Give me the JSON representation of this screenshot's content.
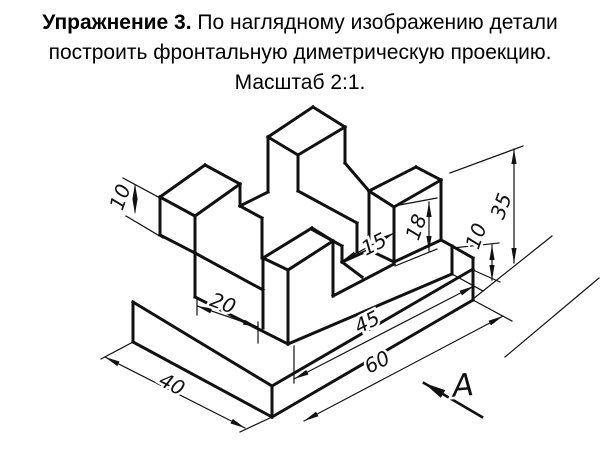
{
  "title": {
    "bold": "Упражнение 3.",
    "rest": " По наглядному изображению детали",
    "line2": "построить фронтальную диметрическую проекцию.",
    "line3": "Масштаб 2:1."
  },
  "drawing": {
    "ink": "#111111",
    "thick_width": 3,
    "thin_width": 1.2,
    "object_segments": [
      [
        133,
        302,
        133,
        342
      ],
      [
        133,
        342,
        272,
        417
      ],
      [
        272,
        417,
        272,
        386
      ],
      [
        133,
        302,
        272,
        386
      ],
      [
        272,
        417,
        473,
        300
      ],
      [
        473,
        258,
        473,
        300
      ],
      [
        272,
        386,
        473,
        269
      ],
      [
        160,
        197,
        205,
        165
      ],
      [
        205,
        165,
        240,
        184
      ],
      [
        240,
        184,
        195,
        216
      ],
      [
        195,
        216,
        160,
        197
      ],
      [
        160,
        197,
        160,
        235
      ],
      [
        195,
        216,
        195,
        297
      ],
      [
        240,
        184,
        240,
        206
      ],
      [
        160,
        235,
        195,
        253
      ],
      [
        195,
        253,
        263,
        290
      ],
      [
        240,
        206,
        268,
        192
      ],
      [
        240,
        206,
        262,
        218
      ],
      [
        262,
        218,
        262,
        258
      ],
      [
        268,
        137,
        313,
        107
      ],
      [
        313,
        107,
        345,
        127
      ],
      [
        345,
        127,
        298,
        155
      ],
      [
        298,
        155,
        268,
        137
      ],
      [
        268,
        137,
        268,
        192
      ],
      [
        298,
        155,
        298,
        191
      ],
      [
        345,
        127,
        345,
        163
      ],
      [
        298,
        191,
        357,
        223
      ],
      [
        345,
        163,
        369,
        191
      ],
      [
        357,
        223,
        357,
        252
      ],
      [
        263,
        258,
        312,
        228
      ],
      [
        312,
        228,
        333,
        241
      ],
      [
        333,
        241,
        288,
        270
      ],
      [
        288,
        270,
        263,
        258
      ],
      [
        263,
        258,
        263,
        328
      ],
      [
        288,
        270,
        288,
        344
      ],
      [
        333,
        241,
        333,
        296
      ],
      [
        313,
        230,
        342,
        246
      ],
      [
        342,
        246,
        342,
        262
      ],
      [
        342,
        262,
        369,
        250
      ],
      [
        342,
        262,
        362,
        277
      ],
      [
        333,
        296,
        394,
        264
      ],
      [
        369,
        191,
        416,
        167
      ],
      [
        416,
        167,
        441,
        180
      ],
      [
        441,
        180,
        394,
        207
      ],
      [
        394,
        207,
        369,
        191
      ],
      [
        369,
        191,
        369,
        250
      ],
      [
        394,
        207,
        394,
        262
      ],
      [
        441,
        180,
        441,
        240
      ],
      [
        369,
        250,
        394,
        262
      ],
      [
        394,
        262,
        441,
        240
      ],
      [
        441,
        240,
        452,
        246
      ],
      [
        452,
        246,
        452,
        274
      ],
      [
        452,
        246,
        473,
        258
      ],
      [
        195,
        297,
        288,
        344
      ],
      [
        288,
        344,
        452,
        274
      ]
    ],
    "view_arrow_line": [
      482,
      417,
      424,
      383
    ],
    "thin_segments": [
      [
        123,
        178,
        162,
        199
      ],
      [
        126,
        216,
        163,
        238
      ],
      [
        135,
        186,
        135,
        212
      ],
      [
        197,
        298,
        197,
        315
      ],
      [
        258,
        322,
        258,
        343
      ],
      [
        197,
        306,
        258,
        327
      ],
      [
        342,
        261,
        394,
        233
      ],
      [
        394,
        206,
        437,
        198
      ],
      [
        395,
        266,
        437,
        249
      ],
      [
        429,
        202,
        429,
        251
      ],
      [
        450,
        173,
        523,
        146
      ],
      [
        473,
        299,
        552,
        236
      ],
      [
        514,
        149,
        514,
        263
      ],
      [
        505,
        357,
        599,
        278
      ],
      [
        453,
        248,
        499,
        243
      ],
      [
        473,
        270,
        500,
        282
      ],
      [
        492,
        245,
        492,
        280
      ],
      [
        133,
        342,
        101,
        359
      ],
      [
        272,
        417,
        240,
        432
      ],
      [
        105,
        357,
        245,
        428
      ],
      [
        473,
        300,
        512,
        321
      ],
      [
        304,
        421,
        503,
        316
      ],
      [
        294,
        346,
        294,
        383
      ],
      [
        452,
        274,
        483,
        291
      ],
      [
        294,
        379,
        474,
        286
      ]
    ],
    "arrows": [
      {
        "x": 135,
        "y": 184,
        "a": -90
      },
      {
        "x": 135,
        "y": 214,
        "a": 90
      },
      {
        "x": 197,
        "y": 306,
        "a": 199
      },
      {
        "x": 258,
        "y": 327,
        "a": 19
      },
      {
        "x": 342,
        "y": 261,
        "a": 152
      },
      {
        "x": 394,
        "y": 233,
        "a": -28
      },
      {
        "x": 429,
        "y": 202,
        "a": -90
      },
      {
        "x": 429,
        "y": 251,
        "a": 90
      },
      {
        "x": 514,
        "y": 149,
        "a": -90
      },
      {
        "x": 514,
        "y": 263,
        "a": 90
      },
      {
        "x": 492,
        "y": 245,
        "a": -90
      },
      {
        "x": 492,
        "y": 280,
        "a": 90
      },
      {
        "x": 105,
        "y": 357,
        "a": 207
      },
      {
        "x": 245,
        "y": 428,
        "a": 27
      },
      {
        "x": 304,
        "y": 421,
        "a": 152
      },
      {
        "x": 503,
        "y": 316,
        "a": -28
      },
      {
        "x": 294,
        "y": 379,
        "a": 153
      },
      {
        "x": 474,
        "y": 286,
        "a": -28
      },
      {
        "x": 424,
        "y": 383,
        "a": 210,
        "len": 22,
        "hw": 4.5
      }
    ],
    "labels": [
      {
        "text": "10",
        "x": 120,
        "y": 197,
        "rot": -70,
        "size": 20
      },
      {
        "text": "20",
        "x": 223,
        "y": 303,
        "rot": 20,
        "size": 20
      },
      {
        "text": "15",
        "x": 374,
        "y": 244,
        "rot": -27,
        "size": 20
      },
      {
        "text": "18",
        "x": 416,
        "y": 227,
        "rot": -70,
        "size": 20
      },
      {
        "text": "35",
        "x": 501,
        "y": 206,
        "rot": -70,
        "size": 20
      },
      {
        "text": "10",
        "x": 476,
        "y": 236,
        "rot": -70,
        "size": 20
      },
      {
        "text": "45",
        "x": 367,
        "y": 322,
        "rot": -27,
        "size": 20
      },
      {
        "text": "60",
        "x": 377,
        "y": 362,
        "rot": -27,
        "size": 20
      },
      {
        "text": "40",
        "x": 172,
        "y": 384,
        "rot": 27,
        "size": 20
      },
      {
        "text": "А",
        "x": 463,
        "y": 385,
        "rot": -5,
        "size": 31
      }
    ]
  }
}
